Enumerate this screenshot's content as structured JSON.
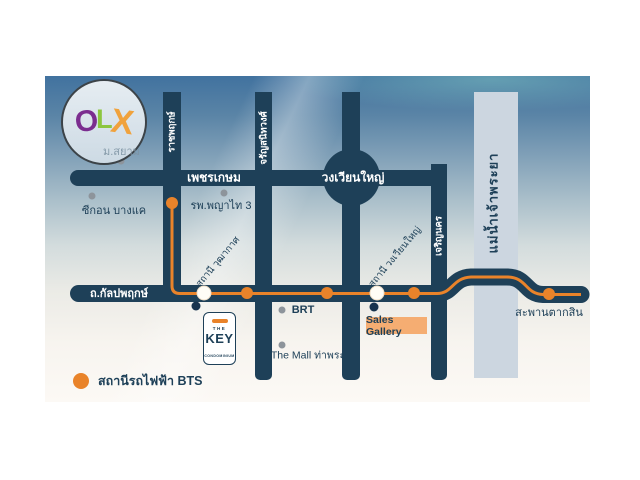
{
  "logo": {
    "o": "O",
    "l": "L",
    "x": "X",
    "watermark": "ม.สยาม"
  },
  "roads": {
    "phetkasem": "เพชรเกษม",
    "wongwian_yai": "วงเวียนใหญ่",
    "kanlapaphruek": "ถ.กัลปพฤกษ์",
    "ratchaphruek": "ราชพฤกษ์",
    "charansanitwong": "จรัญสนิทวงศ์",
    "charoen_nakhon": "เจริญนคร"
  },
  "river": {
    "label": "แม่น้ำเจ้าพระยา"
  },
  "stations": {
    "wutthakat": "สถานี วุฒากาศ",
    "wongwian_yai": "สถานี วงเวียนใหญ่",
    "saphan_taksin": "สะพานตากสิน"
  },
  "places": {
    "seacon": "ซีกอน บางแค",
    "phyathai": "รพ.พญาไท 3",
    "brt": "BRT",
    "mall": "The Mall ท่าพระ",
    "sales_gallery": "Sales Gallery"
  },
  "project": {
    "brand_top": "THE",
    "brand": "KEY",
    "brand_sub": "CONDOMINIUM"
  },
  "legend": {
    "bts": "สถานีรถไฟฟ้า BTS"
  },
  "colors": {
    "navy": "#1e4058",
    "orange": "#e9832a",
    "river": "#ccd6e0",
    "sales_bg": "#f5ad72"
  }
}
